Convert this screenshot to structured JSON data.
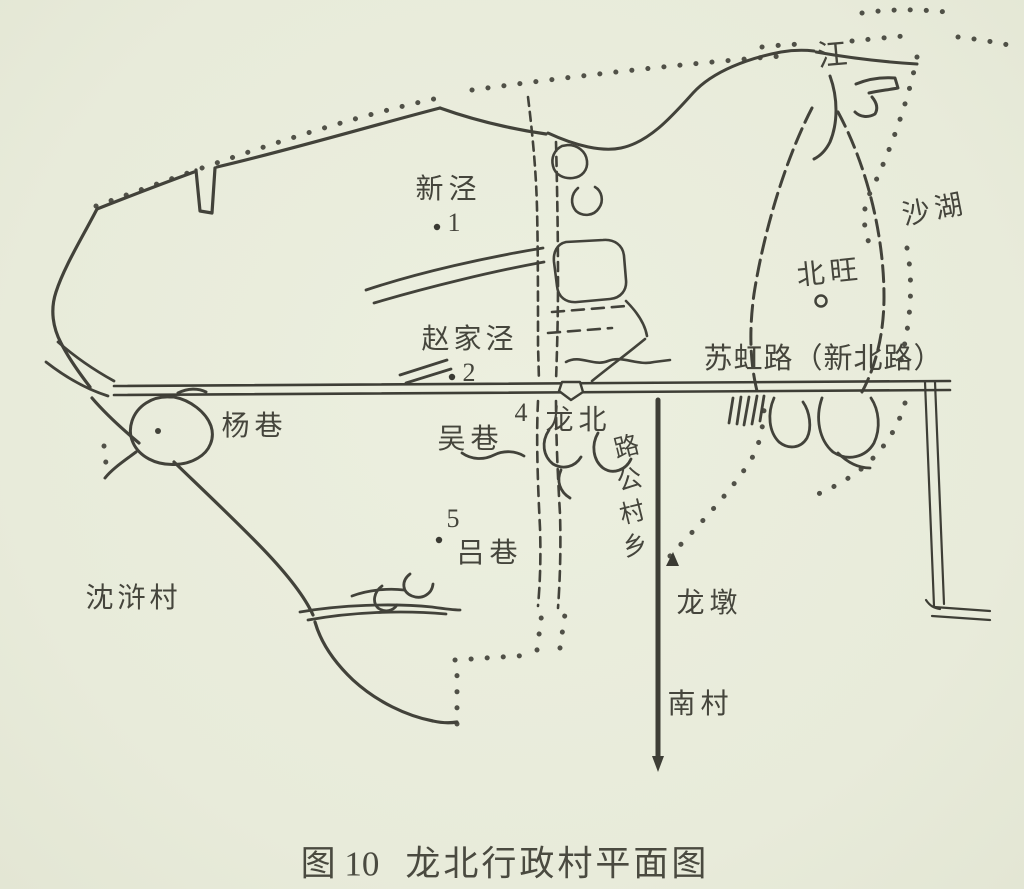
{
  "figure": {
    "caption_figure_no": "图 10",
    "caption_title": "龙北行政村平面图",
    "paper_color": "#e9ecdc",
    "ink_color": "#3e3e36"
  },
  "map": {
    "labels": {
      "jiang": "江",
      "xinjing": "新泾",
      "shahu": "沙湖",
      "beiwang": "北旺",
      "zhaojiajing": "赵家泾",
      "suhong_road": "苏虹路（新北路）",
      "yangxiang": "杨巷",
      "wuxiang": "吴巷",
      "longbei": "龙北",
      "lvxiang": "吕巷",
      "shenhucun": "沈浒村",
      "longdun": "龙墩",
      "nancun": "南村"
    },
    "point_markers": {
      "p1": "1",
      "p2": "2",
      "p4": "4",
      "p5": "5"
    },
    "vertical_road": {
      "reading": "乡村公路",
      "chars_top_to_bottom": [
        "路",
        "公",
        "村",
        "乡"
      ]
    }
  }
}
